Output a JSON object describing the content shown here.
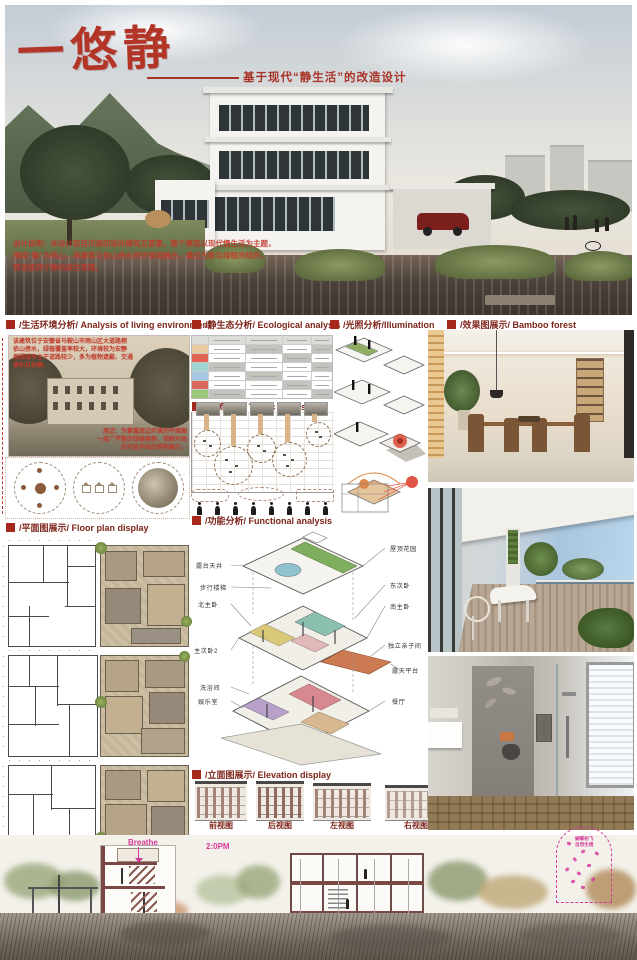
{
  "poster": {
    "title": "一悠静",
    "subtitle": "基于现代“静生活”的改造设计",
    "design_note": {
      "line1": "设计说明：本设计取自河南四班的建筑五要素，整个建筑以现代慢生活为主题，",
      "line2": "围绕“静”为核心，将建筑与依山傍水的环境相融合，通过光影与绿植的组织，",
      "line3": "营造悠然宁静的居住氛围。"
    }
  },
  "sections": {
    "living_env": "/生活环境分析/ Analysis of living environment",
    "ecological": "/静生态分析/ Ecological analysis",
    "illumination": "/光照分析/Illumination",
    "renderings": "/效果图展示/ Bamboo forest",
    "traffic": "/人流分析/ Traffic analysis",
    "functional": "/功能分析/ Functional analysis",
    "floor_plan": "/平面图展示/ Floor plan display",
    "elevation": "/立面图展示/ Elevation display"
  },
  "living_env": {
    "caption_top": [
      "该建筑位于安徽省马鞍山市雨山区大道路侧",
      "依山傍水，绿植覆盖率较大，环境较为安静",
      "周围城市主干道路较少，多为植物遮蔽、交通",
      "便利且安静。"
    ],
    "caption_bottom": [
      "周边：为掌握周边环境的平面图",
      "一层广平整的绿植拥抱、视野开阔",
      "的河道手段的照明展示。"
    ]
  },
  "functional": {
    "labels_left": [
      "露台天井",
      "步行楼梯",
      "北主卧",
      "主次卧2",
      "洗浴间",
      "娱乐室"
    ],
    "labels_right": [
      "屋顶花园",
      "东次卧",
      "南主卧",
      "独立亲子间",
      "露天平台",
      "餐厅"
    ]
  },
  "elevation": {
    "labels": [
      "前视图",
      "后视图",
      "左视图",
      "右视图"
    ]
  },
  "bottom": {
    "breathe": "Breathe",
    "time_note": "2:0PM",
    "butterfly_note_1": "蝴蝶纷飞",
    "butterfly_note_2": "自然生境"
  },
  "colors": {
    "accent_red": "#a5281b",
    "header_text": "#7d241a",
    "title_red": "#b23527",
    "magenta": "#d6399b",
    "eco_row_chips": [
      "#e8c9a0",
      "#e06555",
      "#9fd6d2",
      "#a9c7e0",
      "#d96a5a",
      "#9cc87a"
    ]
  }
}
